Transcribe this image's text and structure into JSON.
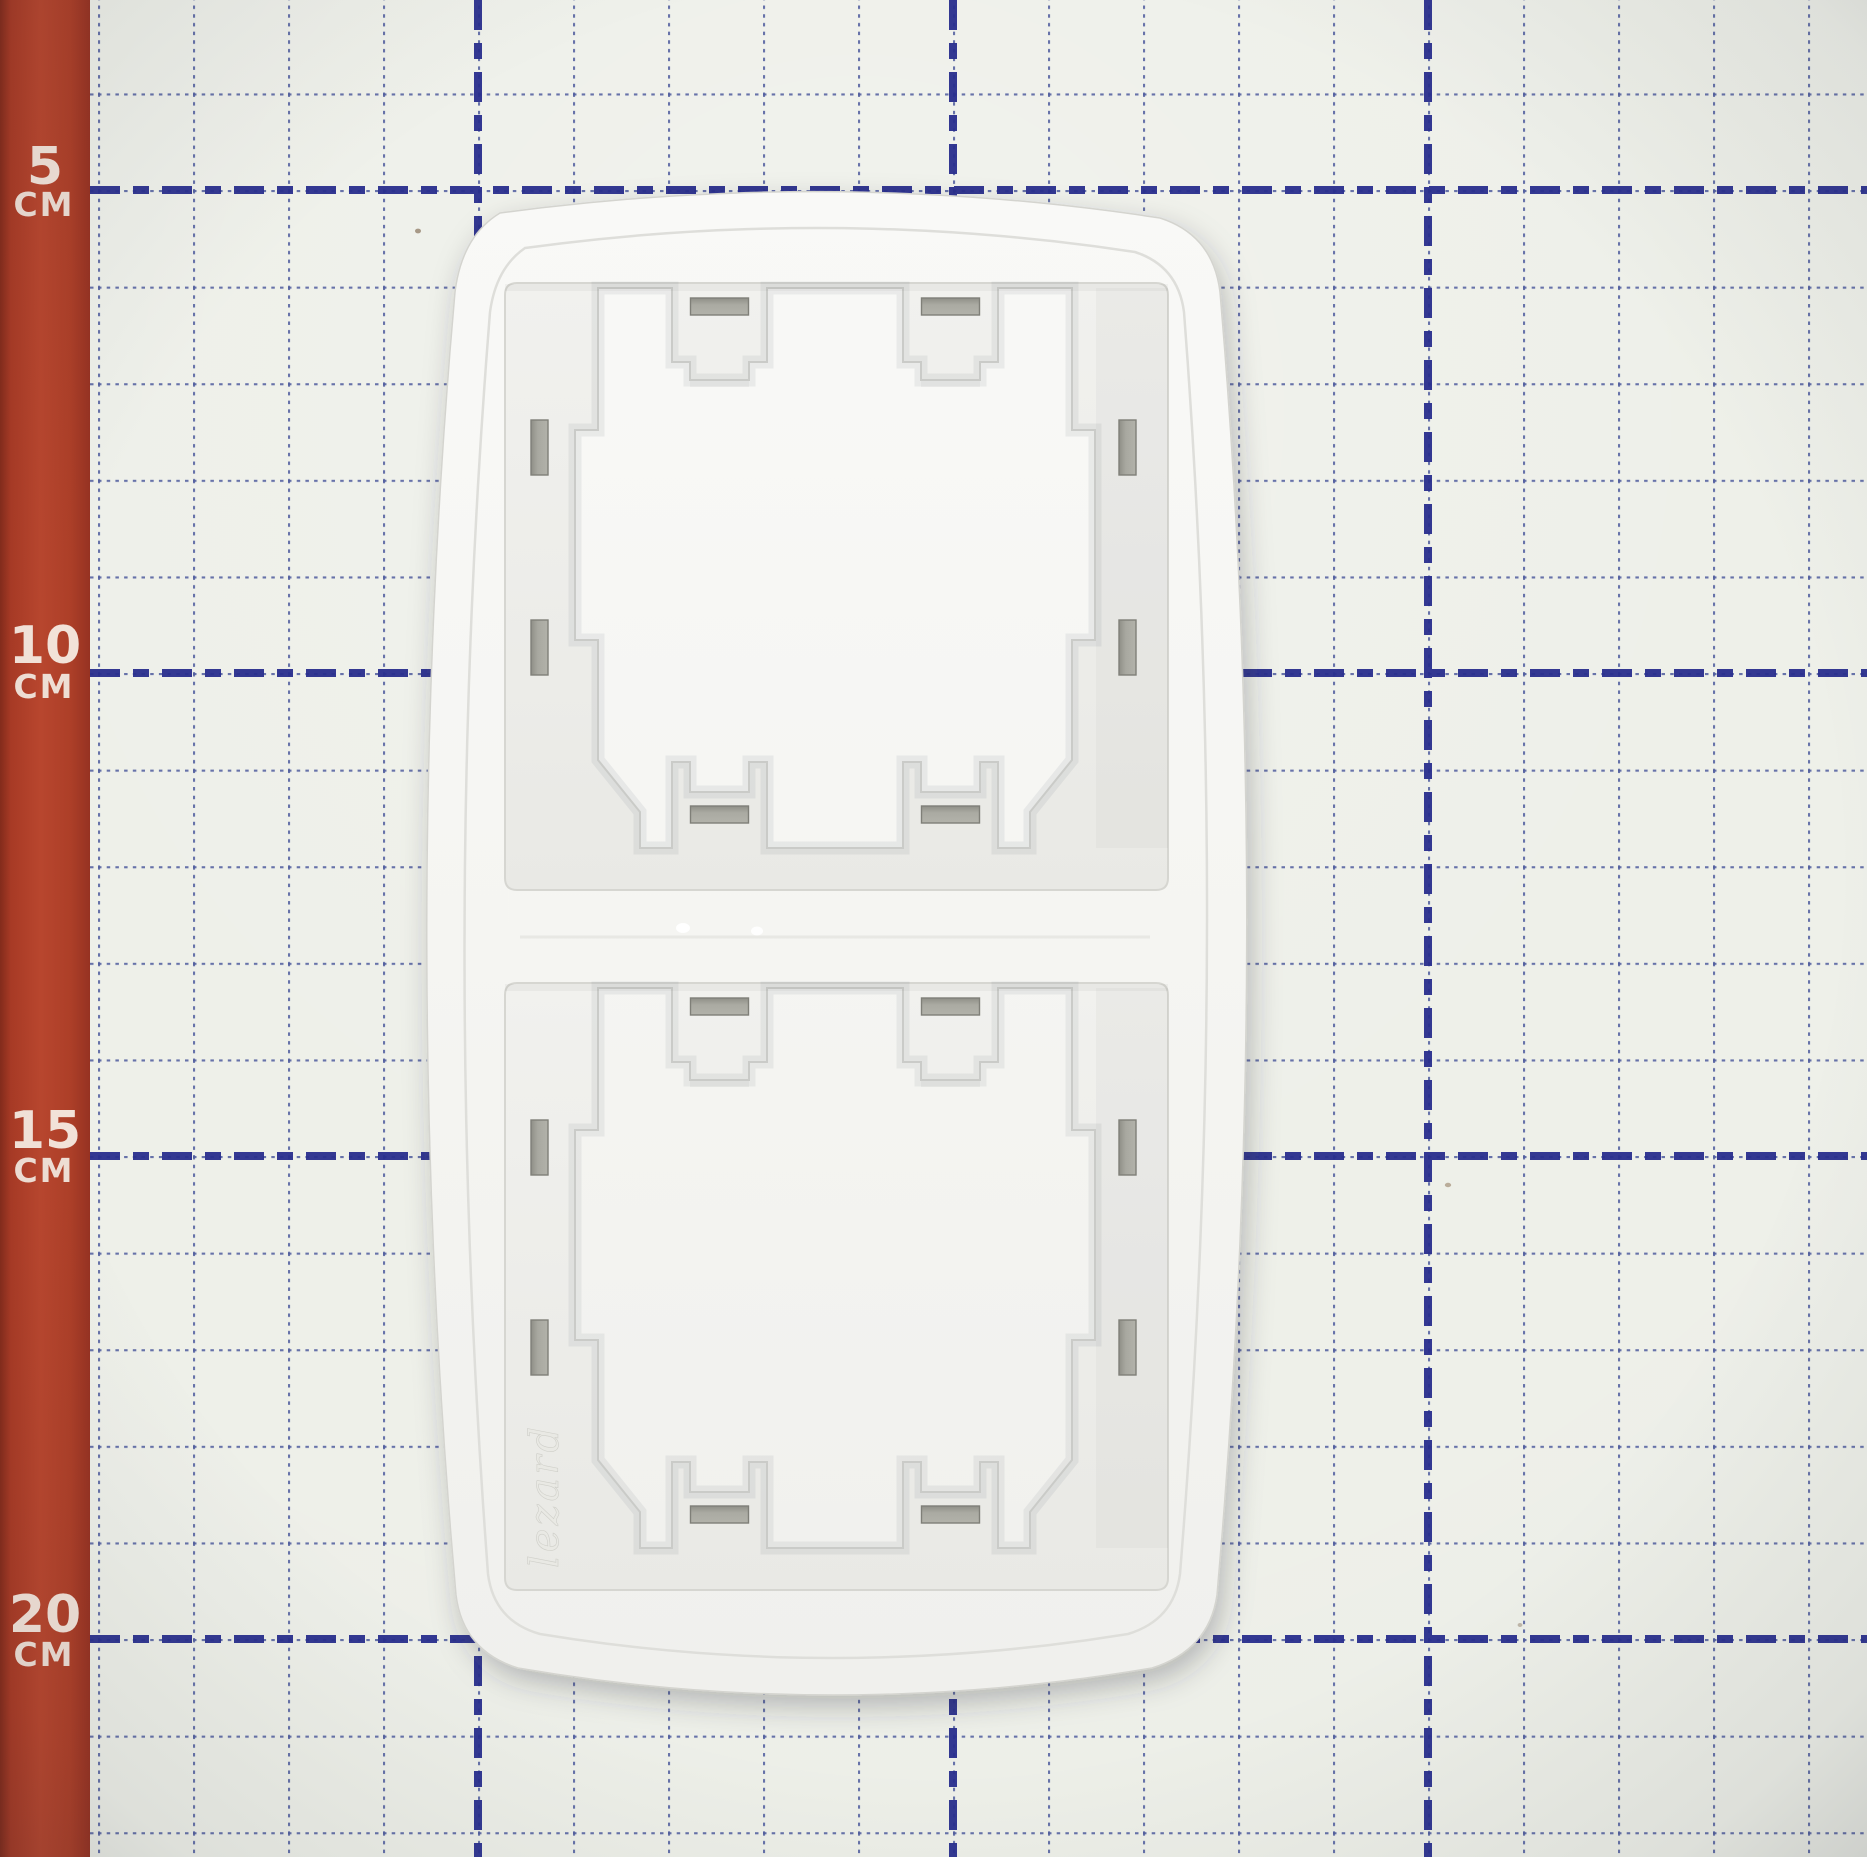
{
  "photo": {
    "subject": "White two-gang vertical switch frame lying back-side-up on a cutting mat with centimeter grid and red ruler strip",
    "frame_orientation": "vertical"
  },
  "ruler": {
    "orientation": "vertical-left",
    "unit": "СМ",
    "marks": [
      {
        "value": "5",
        "unit": "СМ"
      },
      {
        "value": "10",
        "unit": "СМ"
      },
      {
        "value": "15",
        "unit": "СМ"
      },
      {
        "value": "20",
        "unit": "СМ"
      }
    ],
    "strip_color": "#b4432c",
    "text_color": "#f2e2d8"
  },
  "grid": {
    "minor_step": "1 cm",
    "major_step": "5 cm",
    "minor_color": "#4f5b9e",
    "major_color": "#292f8e",
    "mat_color": "#edefe8"
  },
  "frame": {
    "brand_text": "lezard",
    "gang_count": 2,
    "plastic_color": "#f6f6f3",
    "recess_color": "#ececea",
    "slot_color": "#a5a59d"
  }
}
